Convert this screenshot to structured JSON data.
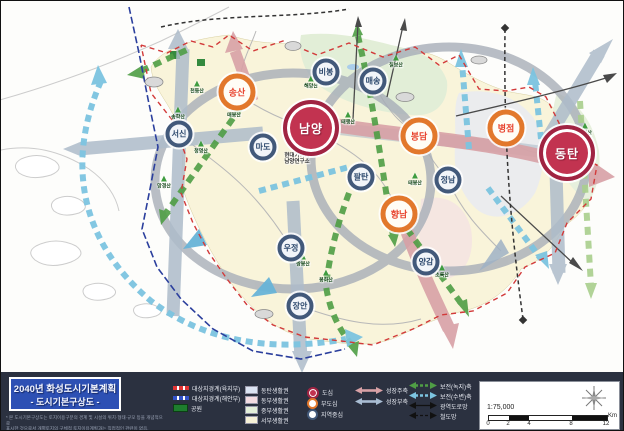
{
  "title": {
    "line1": "2040년 화성도시기본계획",
    "line2": "- 도시기본구상도 -"
  },
  "footnote": {
    "line1": "* 본 도시기본구상도는 토지이용구분의 경계 및 시설의 위치·형태·규모 등을 개념적으로",
    "line2": "표시한 것으로서 개별토지의 구체적 토지이용계획과는 직접적인 관련이 없음."
  },
  "map": {
    "cities": [
      {
        "name": "남양",
        "type": "dosim",
        "x": 310,
        "y": 127
      },
      {
        "name": "동탄",
        "type": "dosim",
        "x": 566,
        "y": 152
      },
      {
        "name": "송산",
        "type": "budosim",
        "x": 236,
        "y": 91
      },
      {
        "name": "봉담",
        "type": "budosim",
        "x": 418,
        "y": 135
      },
      {
        "name": "병점",
        "type": "budosim",
        "x": 505,
        "y": 127
      },
      {
        "name": "향남",
        "type": "budosim",
        "x": 398,
        "y": 213
      },
      {
        "name": "서신",
        "type": "jiyeok",
        "x": 178,
        "y": 133
      },
      {
        "name": "마도",
        "type": "jiyeok",
        "x": 262,
        "y": 146
      },
      {
        "name": "비봉",
        "type": "jiyeok",
        "x": 325,
        "y": 71
      },
      {
        "name": "매송",
        "type": "jiyeok",
        "x": 372,
        "y": 80
      },
      {
        "name": "팔탄",
        "type": "jiyeok",
        "x": 360,
        "y": 176
      },
      {
        "name": "정남",
        "type": "jiyeok",
        "x": 447,
        "y": 179
      },
      {
        "name": "우정",
        "type": "jiyeok",
        "x": 290,
        "y": 247
      },
      {
        "name": "장안",
        "type": "jiyeok",
        "x": 299,
        "y": 305
      },
      {
        "name": "양감",
        "type": "jiyeok",
        "x": 425,
        "y": 261
      }
    ],
    "mountains": [
      {
        "name": "천등산",
        "x": 196,
        "y": 86
      },
      {
        "name": "송학산",
        "x": 177,
        "y": 112
      },
      {
        "name": "매봉산",
        "x": 233,
        "y": 110
      },
      {
        "name": "청명산",
        "x": 200,
        "y": 146
      },
      {
        "name": "망경산",
        "x": 163,
        "y": 181
      },
      {
        "name": "해망산",
        "x": 310,
        "y": 81
      },
      {
        "name": "칠보산",
        "x": 395,
        "y": 60
      },
      {
        "name": "태행산",
        "x": 347,
        "y": 117
      },
      {
        "name": "태봉산",
        "x": 414,
        "y": 178
      },
      {
        "name": "쌍봉산",
        "x": 302,
        "y": 259
      },
      {
        "name": "봉화산",
        "x": 325,
        "y": 275
      },
      {
        "name": "무봉산",
        "x": 584,
        "y": 128
      },
      {
        "name": "초록산",
        "x": 441,
        "y": 270
      }
    ],
    "labels": [
      {
        "lines": [
          "현대기아차",
          "남양연구소"
        ],
        "x": 296,
        "y": 158
      }
    ]
  },
  "legend": {
    "boundary_items": [
      {
        "label": "대상지경계(육지부)",
        "kind": "line-red"
      },
      {
        "label": "대상지경계(해안부)",
        "kind": "line-blue"
      },
      {
        "label": "공원",
        "kind": "park"
      }
    ],
    "zone_items": [
      {
        "label": "동탄생활권",
        "color": "#dbe4f3"
      },
      {
        "label": "동부생활권",
        "color": "#f3dce2"
      },
      {
        "label": "중부생활권",
        "color": "#e3efd9"
      },
      {
        "label": "서부생활권",
        "color": "#f6f1d7"
      }
    ],
    "node_items": [
      {
        "label": "도심",
        "type": "dosim"
      },
      {
        "label": "부도심",
        "type": "budosim"
      },
      {
        "label": "지역중심",
        "type": "jiyeok"
      }
    ],
    "axis_items_a": [
      {
        "label": "성장주축",
        "color": "#d8a1a6",
        "dashed": false,
        "thin": false
      },
      {
        "label": "성장부축",
        "color": "#a9bdd3",
        "dashed": false,
        "thin": false
      }
    ],
    "axis_items_b": [
      {
        "label": "보전(녹지)축",
        "color": "#4f9e45",
        "dashed": true,
        "thin": false
      },
      {
        "label": "보전(수변)축",
        "color": "#7cc4e0",
        "dashed": true,
        "thin": false
      },
      {
        "label": "광역도로망",
        "color": "#111111",
        "dashed": false,
        "thin": true
      },
      {
        "label": "철도망",
        "color": "#111111",
        "dashed": true,
        "thin": true
      }
    ],
    "scale": {
      "ratio": "1:75,000",
      "ticks": [
        "0",
        "2",
        "4",
        "8",
        "12"
      ],
      "unit": "Km"
    }
  },
  "colors": {
    "dosim": "#c23350",
    "budosim_ring": "#e2782c",
    "jiyeok_ring": "#42597a",
    "growth_main": "#d8a1a6",
    "growth_sub": "#a9bdd3",
    "green_axis": "#4f9e45",
    "water_axis": "#7cc4e0",
    "land": "#f9f4da",
    "band_bg": "#2b3140",
    "title_bg": "#2d50b4",
    "boundary_land": "#d23a3a",
    "boundary_coast": "#2b3f9d"
  }
}
